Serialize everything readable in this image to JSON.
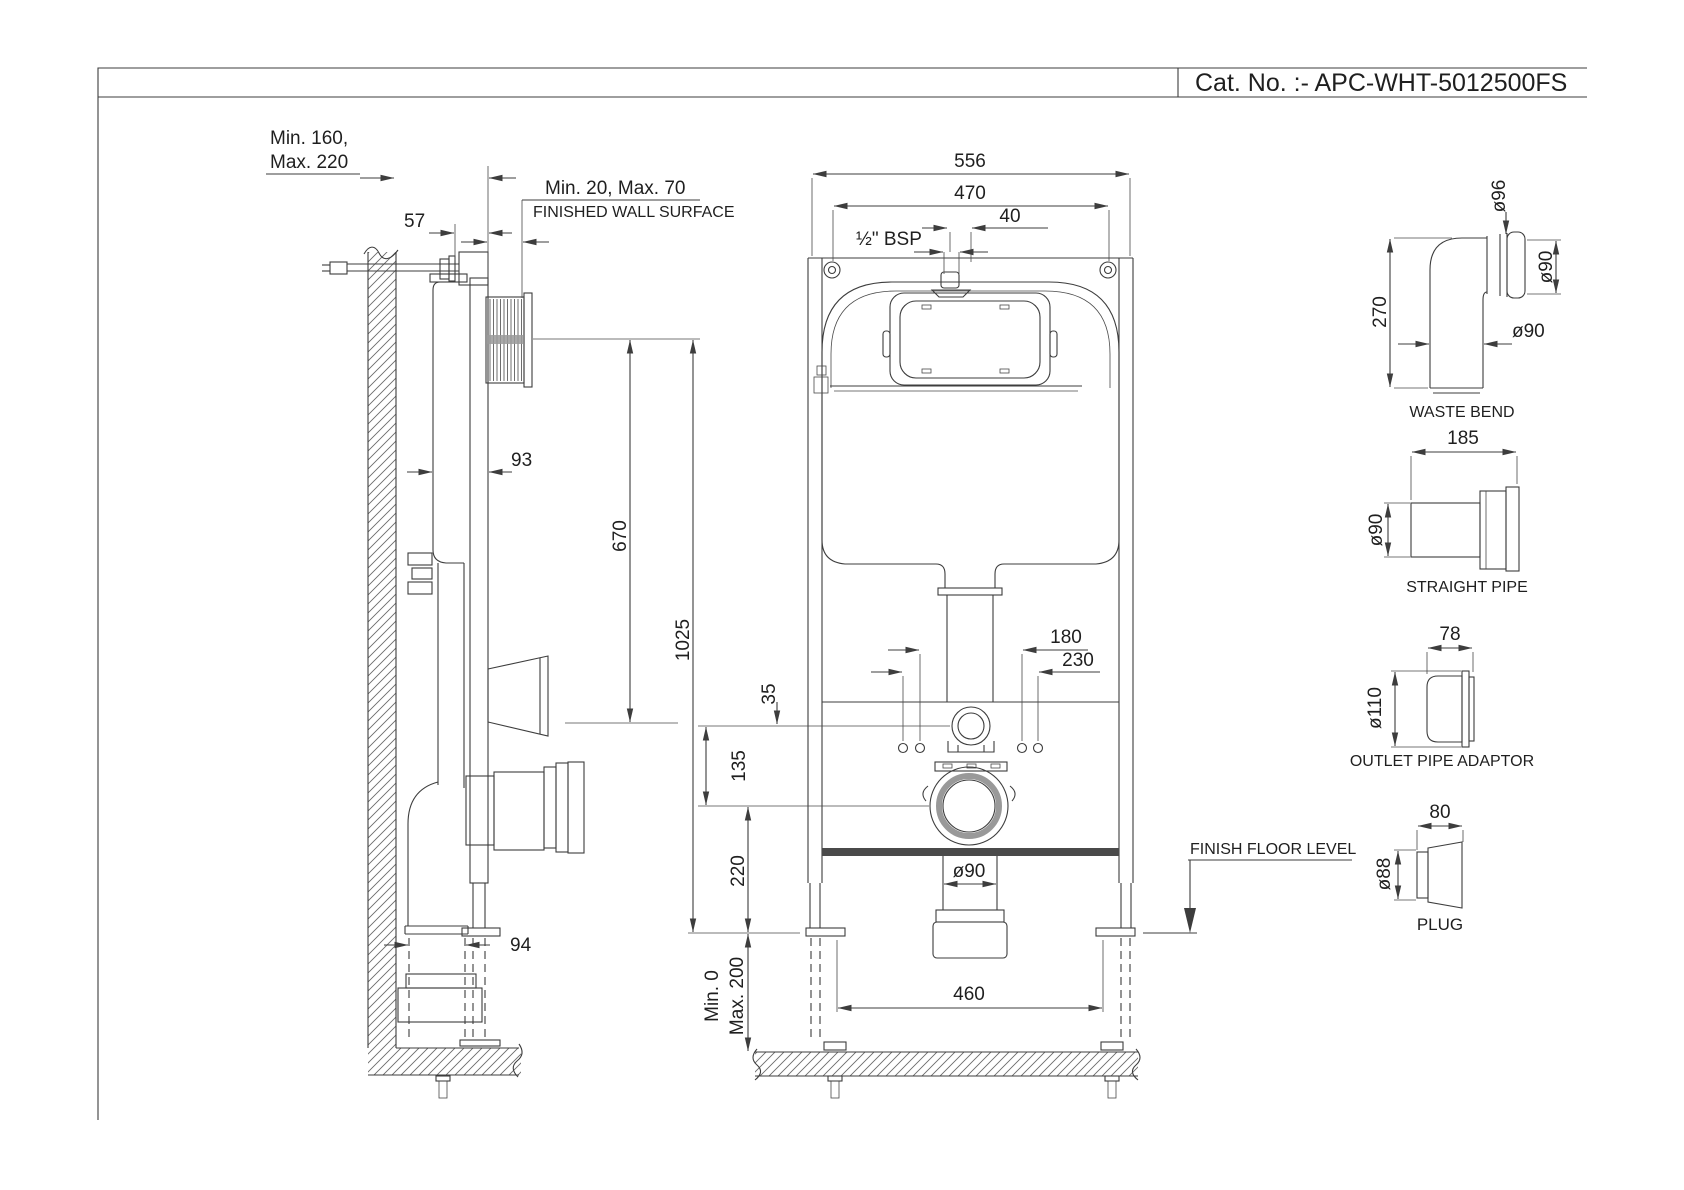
{
  "title_block": {
    "catalog_label": "Cat. No. :- APC-WHT-5012500FS"
  },
  "colors": {
    "line": "#3d3d3d",
    "text": "#1f1f1f"
  },
  "side_view": {
    "dims": {
      "wall_depth_line1": "Min. 160,",
      "wall_depth_line2": "Max. 220",
      "bracket_offset": "57",
      "panel_depth": "Min. 20, Max. 70",
      "finished_wall_label": "FINISHED WALL SURFACE",
      "cistern_depth": "93",
      "plate_to_outlet": "670",
      "frame_height": "1025",
      "outlet_pipe_dia": "94"
    }
  },
  "front_view": {
    "dims": {
      "frame_width": "556",
      "hole_spacing": "470",
      "inlet_offset": "40",
      "inlet_thread": "½\" BSP",
      "plate_to_flush": "35",
      "flush_to_waste": "135",
      "fixing_span_inner": "180",
      "fixing_span_outer": "230",
      "waste_to_base": "220",
      "outlet_dia": "ø90",
      "floor_min": "Min. 0",
      "floor_max": "Max. 200",
      "foot_spacing": "460",
      "floor_label": "FINISH FLOOR LEVEL"
    }
  },
  "accessories": {
    "waste_bend": {
      "name": "WASTE BEND",
      "socket_dia": "ø96",
      "height": "270",
      "pipe_dia_side": "ø90",
      "pipe_dia_bottom": "ø90"
    },
    "straight_pipe": {
      "name": "STRAIGHT PIPE",
      "length": "185",
      "dia": "ø90"
    },
    "outlet_pipe_adaptor": {
      "name": "OUTLET PIPE ADAPTOR",
      "length": "78",
      "dia": "ø110"
    },
    "plug": {
      "name": "PLUG",
      "length": "80",
      "dia": "ø88"
    }
  }
}
